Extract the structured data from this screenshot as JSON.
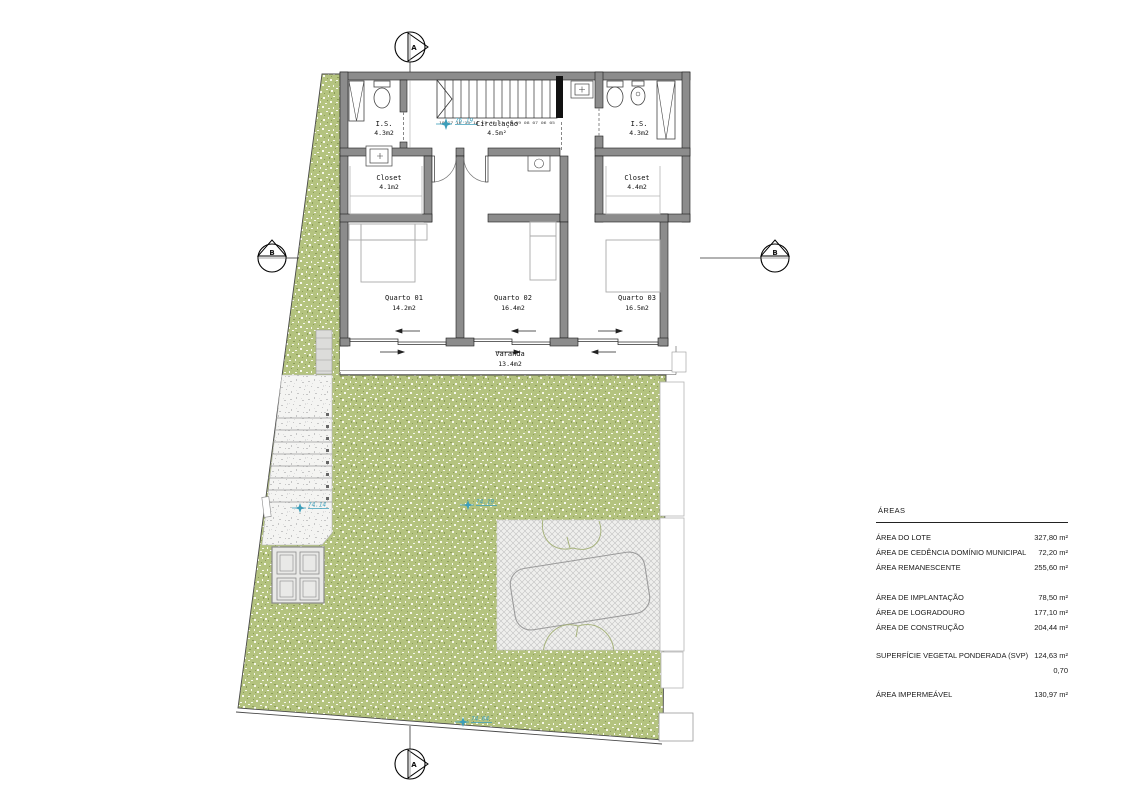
{
  "plan": {
    "section_markers": {
      "a": "A",
      "b": "B"
    },
    "rooms": [
      {
        "name": "I.S.",
        "area": "4.3m2"
      },
      {
        "name": "Circulação",
        "area": "4.5m²"
      },
      {
        "name": "I.S.",
        "area": "4.3m2"
      },
      {
        "name": "Closet",
        "area": "4.1m2"
      },
      {
        "name": "Closet",
        "area": "4.4m2"
      },
      {
        "name": "Quarto 01",
        "area": "14.2m2"
      },
      {
        "name": "Quarto 02",
        "area": "16.4m2"
      },
      {
        "name": "Quarto 03",
        "area": "16.5m2"
      },
      {
        "name": "Varanda",
        "area": "13.4m2"
      }
    ],
    "levels": [
      "76.19",
      "74.14",
      "74.19",
      "74.04"
    ],
    "stairs_numbers": "18 17 16 15 14 13 12 11 10 09 08 07 06 05"
  },
  "areas_table": {
    "title": "ÁREAS",
    "groups": [
      {
        "rows": [
          {
            "label": "ÁREA DO LOTE",
            "value": "327,80 m²"
          },
          {
            "label": "ÁREA DE CEDÊNCIA DOMÍNIO MUNICIPAL",
            "value": "72,20 m²"
          },
          {
            "label": "ÁREA REMANESCENTE",
            "value": "255,60 m²"
          }
        ]
      },
      {
        "rows": [
          {
            "label": "ÁREA DE IMPLANTAÇÃO",
            "value": "78,50 m²"
          },
          {
            "label": "ÁREA DE LOGRADOURO",
            "value": "177,10 m²"
          },
          {
            "label": "ÁREA DE CONSTRUÇÃO",
            "value": "204,44 m²"
          }
        ]
      },
      {
        "rows": [
          {
            "label": "SUPERFÍCIE VEGETAL PONDERADA (SVP)",
            "value": "124,63 m²"
          },
          {
            "label": "",
            "value": "0,70"
          }
        ]
      },
      {
        "rows": [
          {
            "label": "ÁREA IMPERMEÁVEL",
            "value": "130,97 m²"
          }
        ]
      }
    ]
  }
}
